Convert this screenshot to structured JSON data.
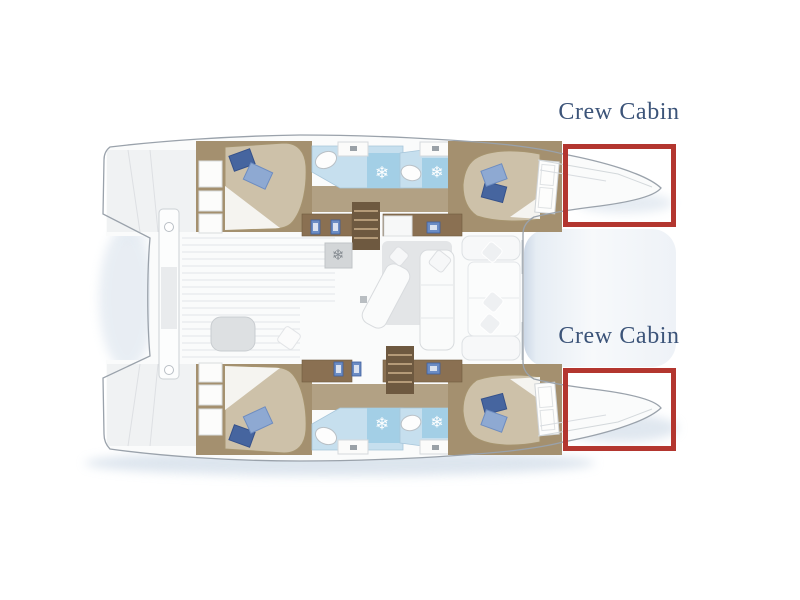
{
  "page": {
    "background": "#ffffff"
  },
  "annotations": {
    "top": {
      "label": "Crew Cabin",
      "target": "starboard-bow-locker"
    },
    "bottom": {
      "label": "Crew Cabin",
      "target": "port-bow-locker"
    }
  },
  "style": {
    "highlight_border": "#b3362f",
    "label_color": "#3c5479",
    "hull_fill": "#fafbfb",
    "outline_gray": "#9aa2ab",
    "wood_brown": "#8a7052",
    "cabin_trim_brown": "#a4906f",
    "floor_tan": "#b2a184",
    "bed_tan": "#cdc1a9",
    "pillow_dark_blue": "#46659f",
    "pillow_light_blue": "#8ea9d2",
    "bathroom_blue": "#c6dfee",
    "shower_blue": "#a3cfe6",
    "saloon_gray": "#edeff0",
    "trampoline_blue": "#ccd8e6",
    "shadow_blue": "#c6d4e3"
  },
  "floorplan": {
    "type": "catamaran-interior-layout",
    "orientation": "bows-right",
    "hull_count": 2,
    "highlighted_areas": 2,
    "features": [
      "aft-double-bed-top-hull",
      "aft-double-bed-bottom-hull",
      "forward-double-bed-top-hull",
      "forward-double-bed-bottom-hull",
      "bathroom-with-shower-x4",
      "companionway-stairs-x2",
      "galley-sinks",
      "freezer",
      "saloon-lounge",
      "chaise",
      "aft-cockpit-bench",
      "cockpit-table",
      "forward-cockpit-seats",
      "bow-trampoline",
      "crew-cabin-bow-top",
      "crew-cabin-bow-bottom"
    ]
  }
}
